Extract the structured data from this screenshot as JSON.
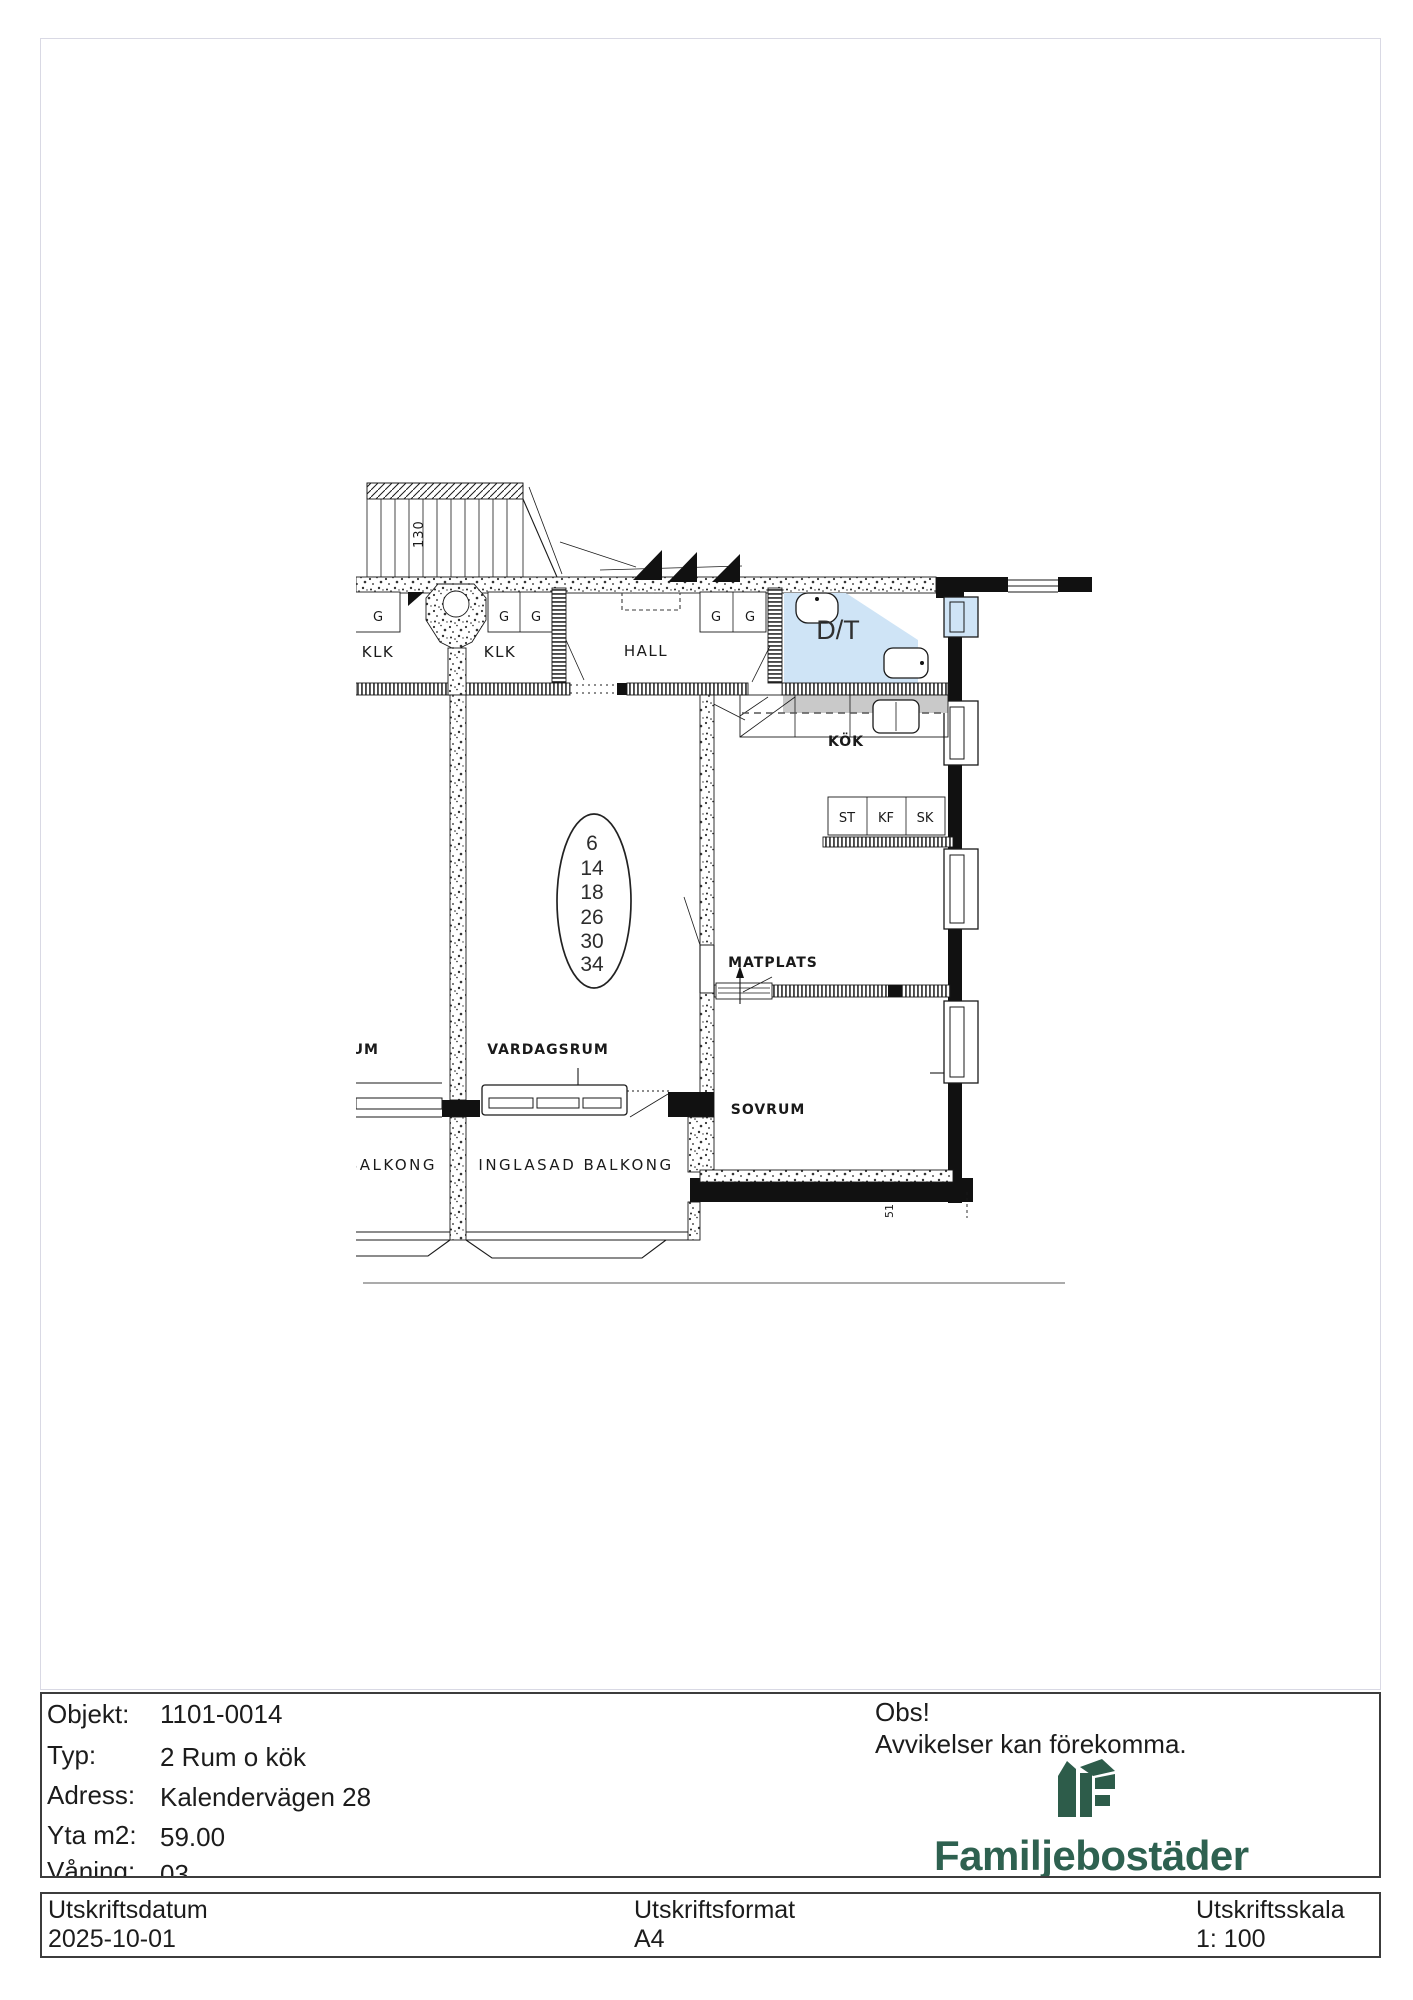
{
  "plan": {
    "stair_dim": "130",
    "pillar_mark": "2",
    "corner_dim": "51",
    "rooms": {
      "klk1": "KLK",
      "klk2": "KLK",
      "hall": "HALL",
      "dt": "D/T",
      "kok": "KÖK",
      "matplats": "MATPLATS",
      "vardagsrum": "VARDAGSRUM",
      "sovrum": "SOVRUM",
      "balkong": "BALKONG",
      "inglasad_balkong": "INGLASAD BALKONG",
      "neighbor_partial": "RUM"
    },
    "closets": [
      "G",
      "G",
      "G",
      "G",
      "G"
    ],
    "cabinets": [
      "ST",
      "KF",
      "SK"
    ],
    "apartment_numbers": [
      "6",
      "14",
      "18",
      "26",
      "30",
      "34"
    ],
    "colors": {
      "bathroom_highlight": "#cfe4f6",
      "counter": "#c9c9c9",
      "logo_green": "#2d5c4a"
    }
  },
  "info": {
    "rows": [
      {
        "label": "Objekt:",
        "value": "1101-0014"
      },
      {
        "label": "Typ:",
        "value": "2 Rum o kök"
      },
      {
        "label": "Adress:",
        "value": "Kalendervägen 28"
      },
      {
        "label": "Yta m2:",
        "value": "59.00"
      },
      {
        "label": "Våning:",
        "value": "03"
      }
    ],
    "notice": {
      "title": "Obs!",
      "body": "Avvikelser kan förekomma."
    },
    "brand": "Familjebostäder"
  },
  "footer": {
    "columns": [
      {
        "label": "Utskriftsdatum",
        "value": "2025-10-01"
      },
      {
        "label": "Utskriftsformat",
        "value": "A4"
      },
      {
        "label": "Utskriftsskala",
        "value": "1: 100"
      }
    ]
  }
}
